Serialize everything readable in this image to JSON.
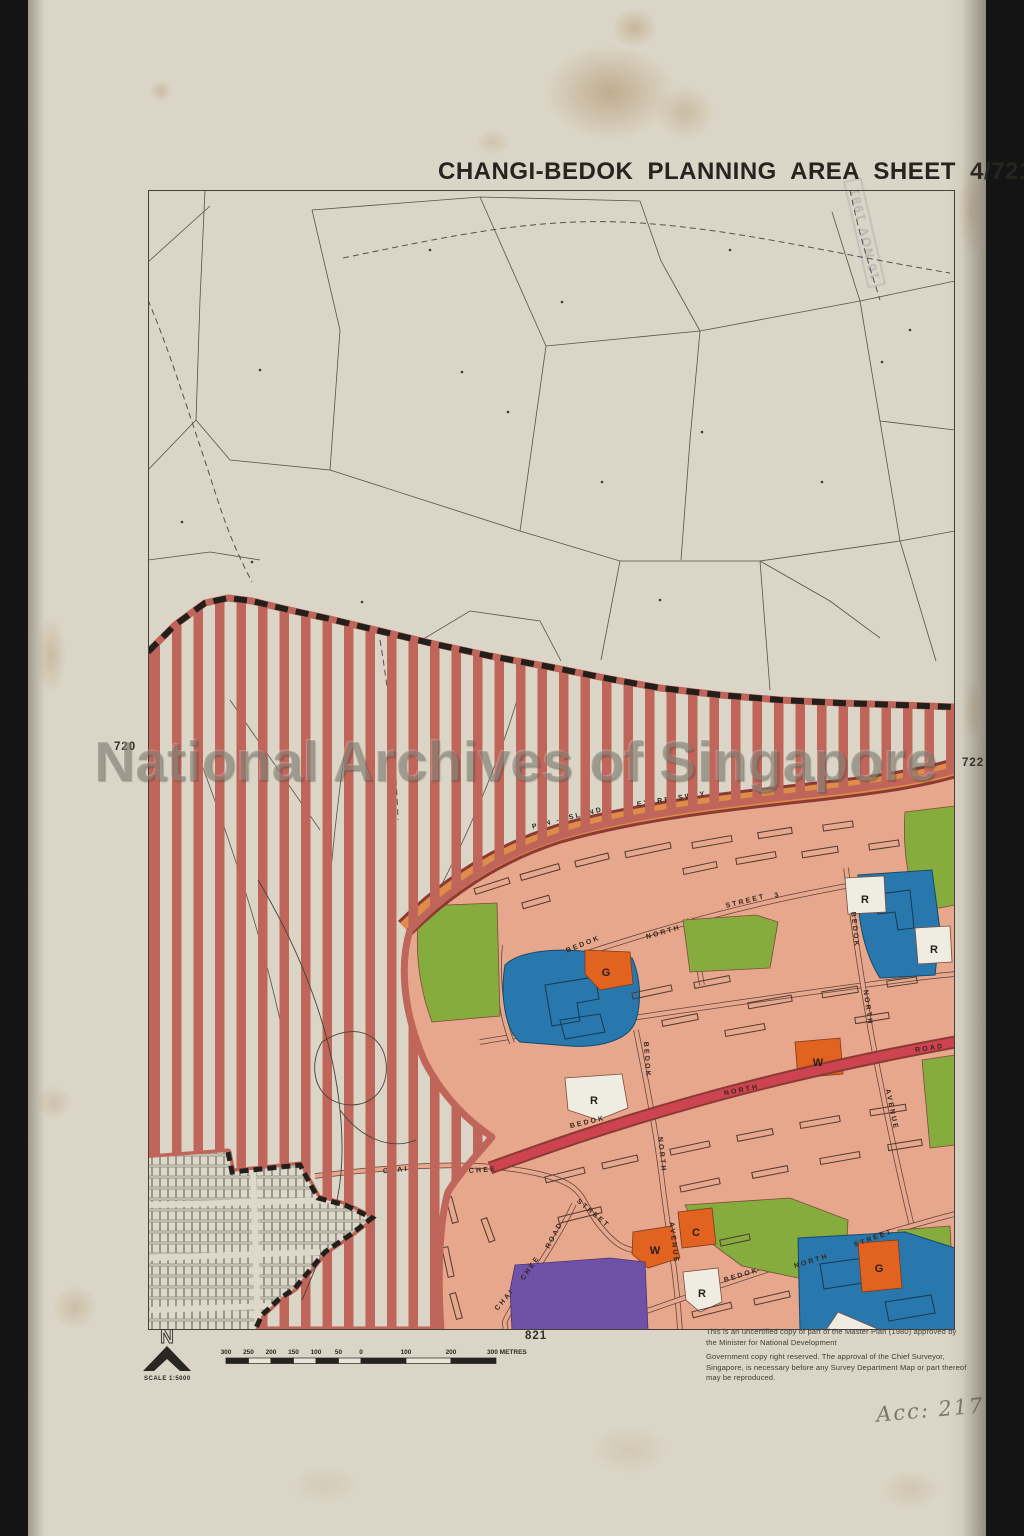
{
  "title": "CHANGI-BEDOK PLANNING AREA SHEET 4/721",
  "watermark": "National Archives of Singapore",
  "stamp": {
    "date": "10 NOV 1981"
  },
  "grid_refs": {
    "left": "720",
    "right": "722",
    "bottom": "821"
  },
  "north_arrow": {
    "letter": "N",
    "scale_label": "SCALE 1:5000"
  },
  "scale_bar": {
    "labels": [
      "300",
      "250",
      "200",
      "150",
      "100",
      "50",
      "0",
      "100",
      "200",
      "300 METRES"
    ]
  },
  "notes": {
    "para1": "This is an uncertified copy of part of the Master Plan (1980) approved by the Minister for National Development",
    "para2": "Government copy right reserved. The approval of the Chief Surveyor, Singapore, is necessary before any Survey Department Map or part thereof may be reproduced."
  },
  "handwritten_accession": "Acc: 217",
  "road_labels": [
    {
      "text": "PAN - ISLAND",
      "x": 568,
      "y": 820,
      "rot": -14
    },
    {
      "text": "EXPRESSWAY",
      "x": 672,
      "y": 801,
      "rot": -9
    },
    {
      "text": "BEDOK",
      "x": 584,
      "y": 946,
      "rot": -22
    },
    {
      "text": "NORTH",
      "x": 664,
      "y": 934,
      "rot": -16
    },
    {
      "text": "STREET",
      "x": 746,
      "y": 903,
      "rot": -14
    },
    {
      "text": "3",
      "x": 778,
      "y": 897,
      "rot": -14
    },
    {
      "text": "BEDOK",
      "x": 588,
      "y": 1124,
      "rot": -13
    },
    {
      "text": "NORTH",
      "x": 742,
      "y": 1092,
      "rot": -11
    },
    {
      "text": "ROAD",
      "x": 930,
      "y": 1050,
      "rot": -9
    },
    {
      "text": "BEDOK",
      "x": 853,
      "y": 930,
      "rot": 84
    },
    {
      "text": "NORTH",
      "x": 866,
      "y": 1008,
      "rot": 82
    },
    {
      "text": "AVENUE",
      "x": 890,
      "y": 1110,
      "rot": 78
    },
    {
      "text": "BEDOK",
      "x": 645,
      "y": 1060,
      "rot": 86
    },
    {
      "text": "NORTH",
      "x": 660,
      "y": 1155,
      "rot": 84
    },
    {
      "text": "AVENUE",
      "x": 672,
      "y": 1243,
      "rot": 83
    },
    {
      "text": "BEDOK",
      "x": 742,
      "y": 1277,
      "rot": -17
    },
    {
      "text": "NORTH",
      "x": 812,
      "y": 1263,
      "rot": -17
    },
    {
      "text": "STREET",
      "x": 874,
      "y": 1240,
      "rot": -20
    },
    {
      "text": "CHAI",
      "x": 396,
      "y": 1172,
      "rot": -6
    },
    {
      "text": "CHEE",
      "x": 483,
      "y": 1172,
      "rot": -4
    },
    {
      "text": "STREET",
      "x": 592,
      "y": 1215,
      "rot": 40
    },
    {
      "text": "ROAD",
      "x": 556,
      "y": 1236,
      "rot": -62
    },
    {
      "text": "CHEE",
      "x": 532,
      "y": 1269,
      "rot": -55
    },
    {
      "text": "CHAI",
      "x": 506,
      "y": 1301,
      "rot": -50
    }
  ],
  "zone_markers": [
    {
      "letter": "G",
      "x": 606,
      "y": 972,
      "type": "orange"
    },
    {
      "letter": "R",
      "x": 865,
      "y": 899,
      "type": "white"
    },
    {
      "letter": "R",
      "x": 934,
      "y": 949,
      "type": "white"
    },
    {
      "letter": "W",
      "x": 818,
      "y": 1062,
      "type": "orange"
    },
    {
      "letter": "R",
      "x": 594,
      "y": 1100,
      "type": "white"
    },
    {
      "letter": "W",
      "x": 655,
      "y": 1250,
      "type": "orange"
    },
    {
      "letter": "C",
      "x": 696,
      "y": 1232,
      "type": "orange"
    },
    {
      "letter": "R",
      "x": 702,
      "y": 1293,
      "type": "white"
    },
    {
      "letter": "G",
      "x": 879,
      "y": 1268,
      "type": "orange"
    }
  ],
  "colors": {
    "paper": "#d9d4c5",
    "map_bg": "#d8d3c4",
    "stripe": "#c0655a",
    "urban": "#e7a78d",
    "expressway": "#dd8c4a",
    "major_road": "#cd4450",
    "road_edge": "#8c3a34",
    "green": "#86ac3e",
    "blue": "#2878ae",
    "orange": "#e2621f",
    "purple": "#6f51a8",
    "white_parcel": "#efece1",
    "boundary_black": "#23201c",
    "ink": "#2e2b26"
  }
}
